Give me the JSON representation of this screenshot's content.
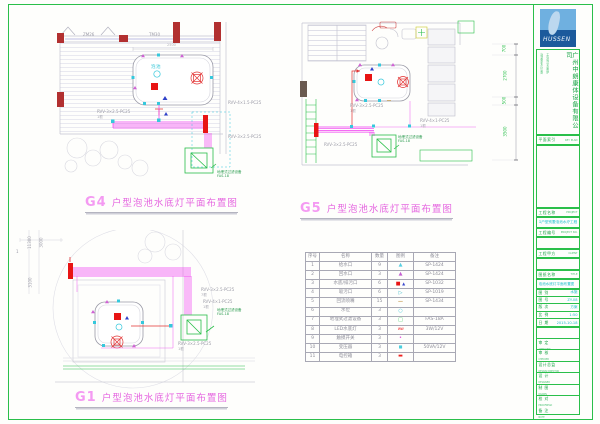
{
  "plans": {
    "g4": {
      "code": "G4",
      "title": "户型泡池水底灯平面布置图",
      "tags": {
        "t1": "ZM26",
        "t2": "TM30"
      },
      "pool_label": "泡池",
      "dim_top": "2500",
      "cable1": "RVV-3×2.5-PC25",
      "cable1n": "1根",
      "cable2": "RVV-4×1.5-PC25",
      "cable2n": "1根",
      "cable3": "RVV-3×2.5-PC25",
      "cable3n": "1根",
      "note1": "地埋式过滤设备",
      "note2": "FAS-18"
    },
    "g5": {
      "code": "G5",
      "title": "户型泡池水底灯平面布置图",
      "cable1": "RVV-3×2.5-PC25",
      "cable1n": "1根",
      "cable2": "RVV-4×1-PC25",
      "cable2n": "1根",
      "cable3": "RVV-3×2.5-PC25",
      "cable3n": "1根",
      "note1": "地埋式过滤设备",
      "note2": "FAS-18",
      "dims": {
        "d1": "700",
        "d2": "2700",
        "d3": "500",
        "d4": "3500"
      }
    },
    "g1": {
      "code": "G1",
      "title": "户型泡池水底灯平面布置图",
      "dims": {
        "d1": "11300",
        "d2": "3000",
        "d3": "3100",
        "mark": "1"
      },
      "cable1": "RVV-3×2.5-PC25",
      "cable1n": "7根",
      "cable2": "RVV-4×1-PC25",
      "cable2n": "1根",
      "cable3": "RVV-3×2.5-PC25",
      "cable3n": "1根",
      "note1": "地埋式过滤设备",
      "note2": "FAS-18"
    }
  },
  "legend": {
    "headers": {
      "no": "序号",
      "name": "名称",
      "qty": "数量",
      "sym": "图例",
      "remark": "备注"
    },
    "rows": [
      {
        "no": "1",
        "name": "给水口",
        "qty": "9",
        "symbol": "cyan-triangle",
        "remark": "SP-1424"
      },
      {
        "no": "2",
        "name": "回水口",
        "qty": "3",
        "symbol": "magenta-triangle",
        "remark": "SP-1424"
      },
      {
        "no": "3",
        "name": "水底/排污口",
        "qty": "6",
        "symbol": "red-square-blue-triangle",
        "remark": "SP-1032"
      },
      {
        "no": "4",
        "name": "吸污口",
        "qty": "6",
        "symbol": "cyan-nozzle",
        "remark": "SP-1019"
      },
      {
        "no": "5",
        "name": "回流喷嘴",
        "qty": "15",
        "symbol": "tan-dash",
        "remark": "SP-1434"
      },
      {
        "no": "6",
        "name": "水位",
        "qty": "3",
        "symbol": "cyan-circle",
        "remark": ""
      },
      {
        "no": "7",
        "name": "地埋式过滤设备",
        "qty": "3",
        "symbol": "green-square",
        "remark": "FAS-18A"
      },
      {
        "no": "8",
        "name": "LED水底灯",
        "qty": "3",
        "symbol": "red-zigzag",
        "remark": "3W/12V"
      },
      {
        "no": "9",
        "name": "触摸开关",
        "qty": "3",
        "symbol": "magenta-dot",
        "remark": ""
      },
      {
        "no": "10",
        "name": "变压器",
        "qty": "3",
        "symbol": "cyan-square",
        "remark": "50VA/12V"
      },
      {
        "no": "11",
        "name": "电控箱",
        "qty": "3",
        "symbol": "red-rect",
        "remark": ""
      }
    ]
  },
  "titleblock": {
    "logo_text": "HUSSEN",
    "company": "广州中朗康体设备有限公司",
    "company_line1": "泳池桑拿水疗设备",
    "company_line2": "工程设计安装维护",
    "keyplan_cn": "平面索引",
    "keyplan_en": "KEY PLAN",
    "f1_cn": "工程名称",
    "f1_en": "PROJECT",
    "project_name": "G户型别墅泡池水疗工程",
    "f2_cn": "工程编号",
    "f2_en": "PROJECT NO.",
    "f3_cn": "工程甲方",
    "f3_en": "CLIENT",
    "f4_cn": "图纸名称",
    "f4_en": "TITLE",
    "sheet_title": "泡池水底灯平面布置图",
    "info": [
      {
        "label": "图 别",
        "value": "水施"
      },
      {
        "label": "图 号",
        "value": "ZY-08"
      },
      {
        "label": "版 次",
        "value": "方案"
      },
      {
        "label": "比 例",
        "value": "1:50"
      },
      {
        "label": "日 期",
        "value": "2015-10-18"
      }
    ],
    "staff": [
      {
        "cn": "审 定",
        "en": "APPROVED"
      },
      {
        "cn": "审 核",
        "en": "CHECKED"
      },
      {
        "cn": "设计总监",
        "en": "DESIGN DIRECTOR"
      },
      {
        "cn": "设 计",
        "en": "DESIGNED"
      },
      {
        "cn": "制 图",
        "en": "DRAWN"
      },
      {
        "cn": "校 对",
        "en": "PROOFREAD"
      },
      {
        "cn": "备 注",
        "en": "NOTE"
      }
    ]
  }
}
